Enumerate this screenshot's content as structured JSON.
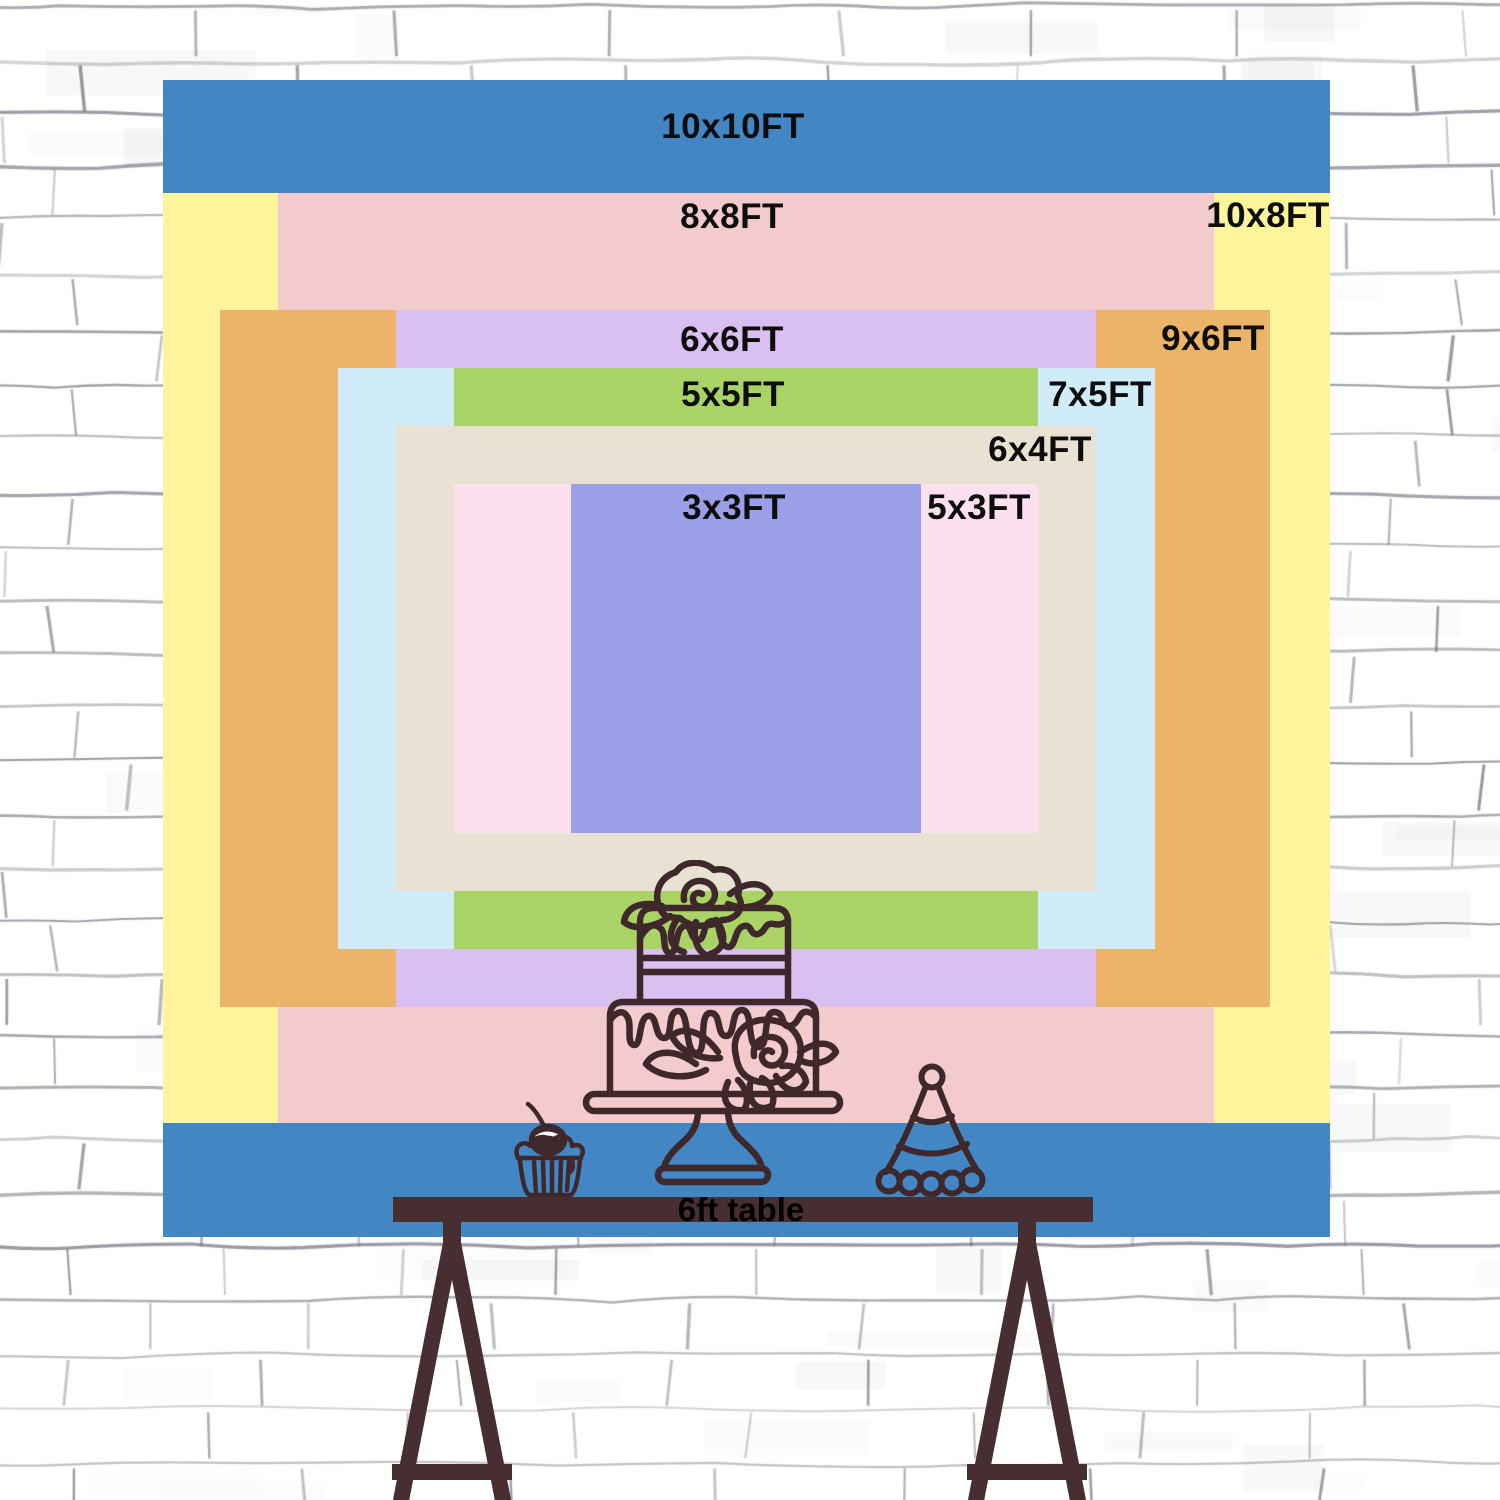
{
  "backdrop": {
    "sizes": [
      {
        "id": "10x10",
        "label": "10x10FT",
        "width_ft": 10,
        "height_ft": 10,
        "color": "#4286c4"
      },
      {
        "id": "10x8",
        "label": "10x8FT",
        "width_ft": 10,
        "height_ft": 8,
        "color": "#fdf49c"
      },
      {
        "id": "8x8",
        "label": "8x8FT",
        "width_ft": 8,
        "height_ft": 8,
        "color": "#f4cbcd"
      },
      {
        "id": "9x6",
        "label": "9x6FT",
        "width_ft": 9,
        "height_ft": 6,
        "color": "#ecb469"
      },
      {
        "id": "6x6",
        "label": "6x6FT",
        "width_ft": 6,
        "height_ft": 6,
        "color": "#d9c0f0"
      },
      {
        "id": "7x5",
        "label": "7x5FT",
        "width_ft": 7,
        "height_ft": 5,
        "color": "#cfecf8"
      },
      {
        "id": "5x5",
        "label": "5x5FT",
        "width_ft": 5,
        "height_ft": 5,
        "color": "#a9d365"
      },
      {
        "id": "6x4",
        "label": "6x4FT",
        "width_ft": 6,
        "height_ft": 4,
        "color": "#e9e2d2"
      },
      {
        "id": "5x3",
        "label": "5x3FT",
        "width_ft": 5,
        "height_ft": 3,
        "color": "#fde0f0"
      },
      {
        "id": "3x3",
        "label": "3x3FT",
        "width_ft": 3,
        "height_ft": 3,
        "color": "#9a9fe7"
      }
    ],
    "label_color": "#0d0d0d"
  },
  "table": {
    "label": "6ft table",
    "color": "#472e31"
  },
  "decorations": {
    "cake": "two-tier-drip-cake-with-roses",
    "cupcake": "cupcake-with-cherry",
    "hat": "striped-party-hat",
    "outline_color": "#3f282b"
  },
  "wall": {
    "base_color": "#ffffff",
    "mortar_line_color": "#6a6c78"
  }
}
